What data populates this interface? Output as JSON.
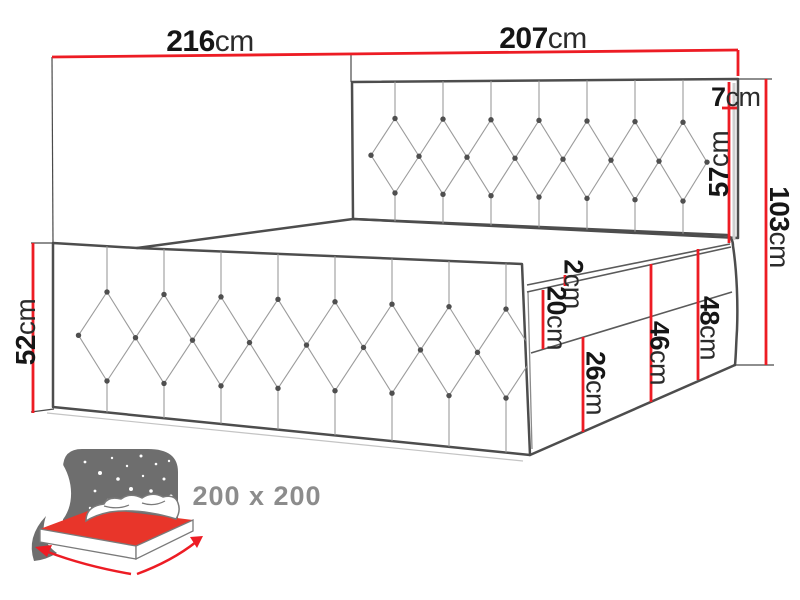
{
  "diagram": {
    "dim_depth_top": {
      "num": "216",
      "unit": "cm"
    },
    "dim_width_top": {
      "num": "207",
      "unit": "cm"
    },
    "dim_headboard_top_offset": {
      "num": "7",
      "unit": "cm"
    },
    "dim_headboard_front": {
      "num": "57",
      "unit": "cm"
    },
    "dim_headboard_total": {
      "num": "103",
      "unit": "cm"
    },
    "dim_side_height": {
      "num": "52",
      "unit": "cm"
    },
    "dim_mattress_lip": {
      "num": "2",
      "unit": "cm"
    },
    "dim_mattress_height": {
      "num": "20",
      "unit": "cm"
    },
    "dim_lower_base_height": {
      "num": "26",
      "unit": "cm"
    },
    "dim_base_total_height": {
      "num": "46",
      "unit": "cm"
    },
    "dim_base_with_lip": {
      "num": "48",
      "unit": "cm"
    }
  },
  "badge": {
    "mattress_size": "200 x 200"
  },
  "colors": {
    "dimension_red": "#ed1c24",
    "outline_gray": "#4d4d4d",
    "icon_gray": "#6e6e6e",
    "text_gray": "#8c8c8c"
  }
}
